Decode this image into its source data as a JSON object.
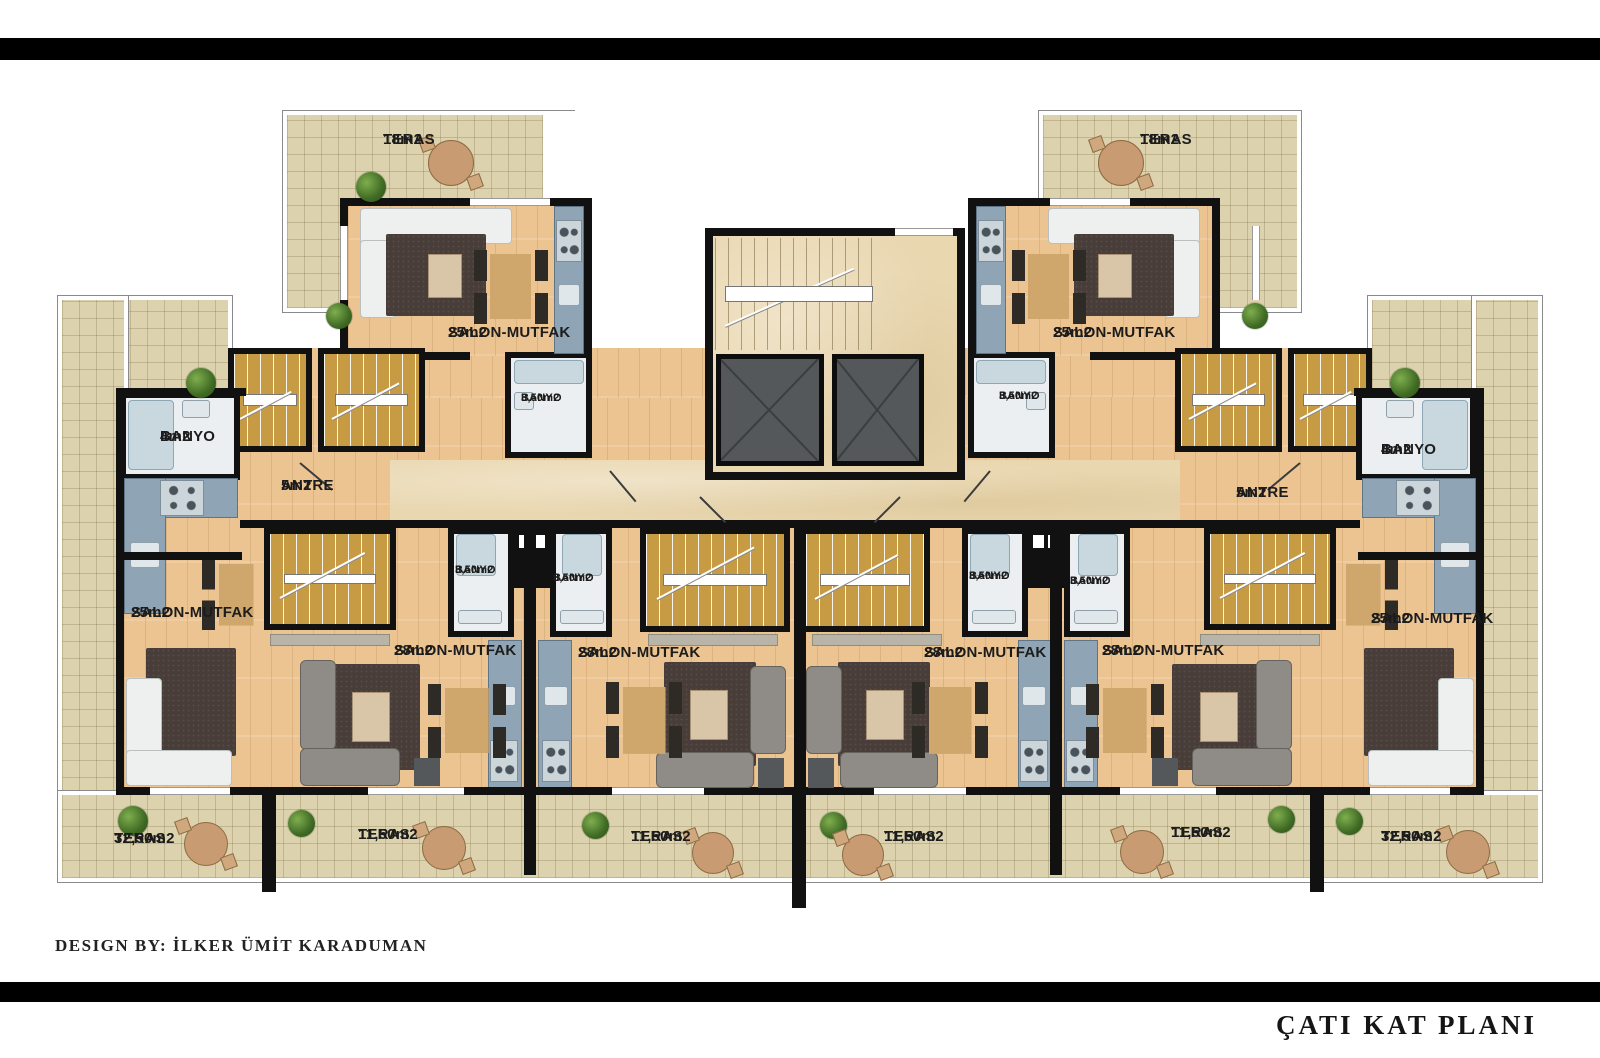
{
  "title": "ÇATI KAT PLANI",
  "credit": "DESIGN BY: İLKER ÜMİT KARADUMAN",
  "plan": {
    "floor_name": "ÇATI KAT PLANI",
    "rooms": [
      {
        "id": "t18l",
        "name": "TERAS",
        "area": "18m2"
      },
      {
        "id": "t18r",
        "name": "TERAS",
        "area": "18m2"
      },
      {
        "id": "s25tl",
        "name": "SALON-MUTFAK",
        "area": "25m2"
      },
      {
        "id": "s25tr",
        "name": "SALON-MUTFAK",
        "area": "25m2"
      },
      {
        "id": "b35tl",
        "name": "BANYO",
        "area": "3,50m2"
      },
      {
        "id": "b35tr",
        "name": "BANYO",
        "area": "3,50m2"
      },
      {
        "id": "b4l",
        "name": "BANYO",
        "area": "4m2"
      },
      {
        "id": "b4r",
        "name": "BANYO",
        "area": "4m2"
      },
      {
        "id": "a5l",
        "name": "ANTRE",
        "area": "5m2"
      },
      {
        "id": "a5r",
        "name": "ANTRE",
        "area": "5m2"
      },
      {
        "id": "s25l",
        "name": "SALON-MUTFAK",
        "area": "25m2"
      },
      {
        "id": "s25r",
        "name": "SALON-MUTFAK",
        "area": "25m2"
      },
      {
        "id": "b35m1",
        "name": "BANYO",
        "area": "3,50m2"
      },
      {
        "id": "b35m2",
        "name": "BANYO",
        "area": "3,50m2"
      },
      {
        "id": "b35m3",
        "name": "BANYO",
        "area": "3,50m2"
      },
      {
        "id": "b35m4",
        "name": "BANYO",
        "area": "3,50m2"
      },
      {
        "id": "s28a",
        "name": "SALON-MUTFAK",
        "area": "28m2"
      },
      {
        "id": "s28b",
        "name": "SALON-MUTFAK",
        "area": "28m2"
      },
      {
        "id": "s28c",
        "name": "SALON-MUTFAK",
        "area": "28m2"
      },
      {
        "id": "s28d",
        "name": "SALON-MUTFAK",
        "area": "28m2"
      },
      {
        "id": "t32l",
        "name": "TERAS",
        "area": "32,50m2"
      },
      {
        "id": "t115a",
        "name": "TERAS",
        "area": "11,50m2"
      },
      {
        "id": "t115b",
        "name": "TERAS",
        "area": "11,50m2"
      },
      {
        "id": "t115c",
        "name": "TERAS",
        "area": "11,50m2"
      },
      {
        "id": "t115d",
        "name": "TERAS",
        "area": "11,50m2"
      },
      {
        "id": "t32r",
        "name": "TERAS",
        "area": "32,50m2"
      }
    ]
  },
  "colors": {
    "wall": "#111111",
    "wood_floor": "#ecc492",
    "terrace_tile": "#dcd2ad",
    "stair": "#c79b43",
    "kitchen_counter": "#8fa4b5",
    "bath_floor": "#eceff1",
    "elevator": "#54585b",
    "rug": "#483d39",
    "plant": "#4e7d32"
  }
}
